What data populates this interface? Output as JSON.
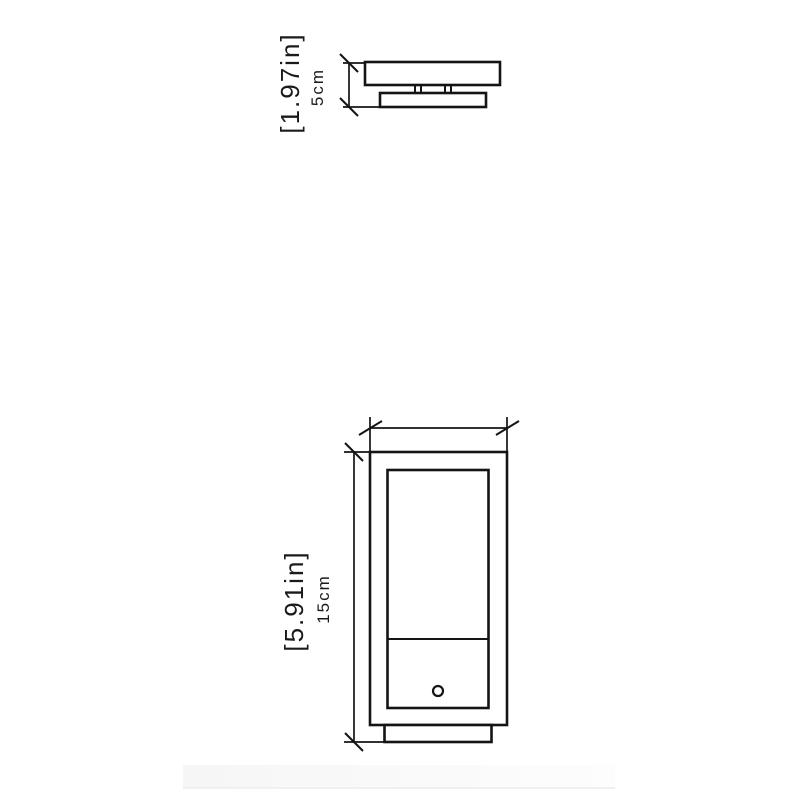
{
  "page": {
    "background_color": "#ffffff",
    "line_color": "#141414",
    "text_color": "#1a1a1a"
  },
  "drawing": {
    "type": "technical-dimension-drawing",
    "views": {
      "top_profile": {
        "description": "side profile of fixture canopy with mounting plate",
        "height_label_in": "[1.97in]",
        "height_label_cm": "5cm"
      },
      "front": {
        "description": "front elevation of rectangular fixture with inner panel, divider and knob",
        "height_label_in": "[5.91in]",
        "height_label_cm": "15cm"
      }
    }
  }
}
